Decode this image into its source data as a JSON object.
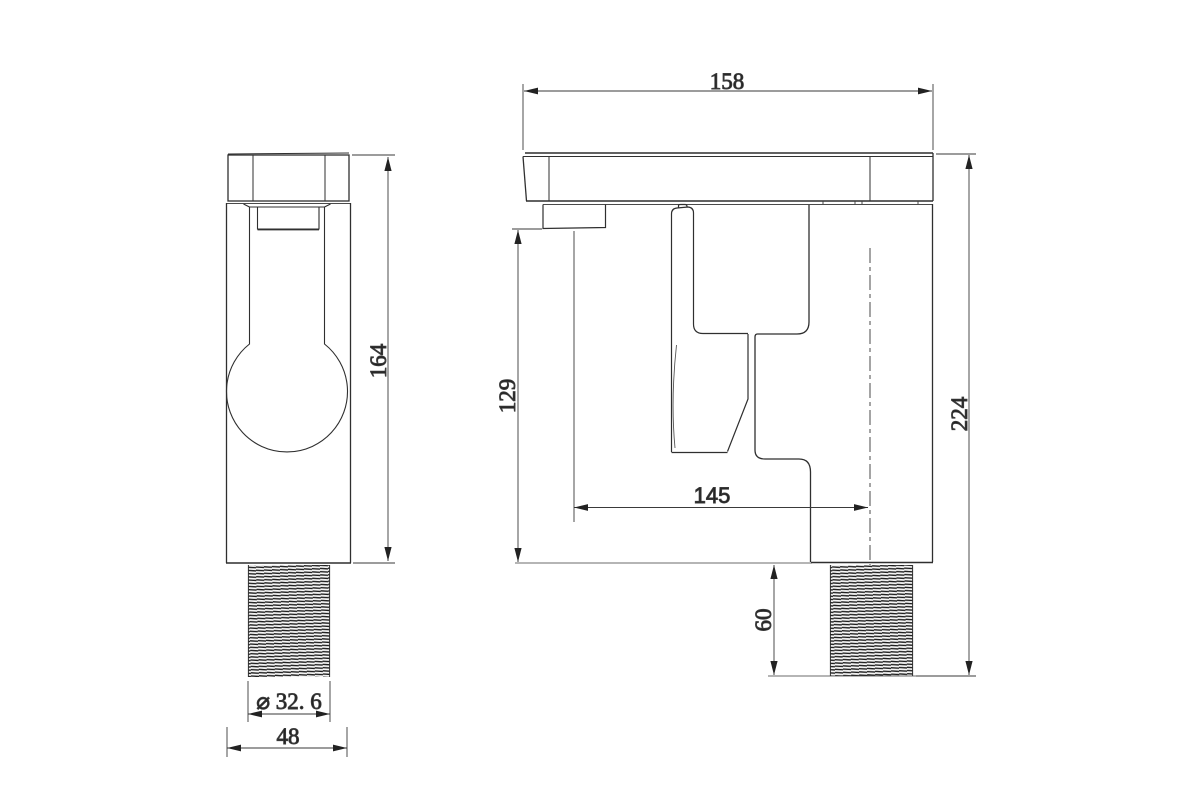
{
  "page": {
    "background": "#ffffff"
  },
  "drawing": {
    "type": "technical-dimension-drawing",
    "subject": "single-handle basin faucet, front and side orthographic views",
    "colors": {
      "outline": "#2f2f2f",
      "thin_line": "#4a4a4a",
      "dimension": "#3a3a3a",
      "thread_fill": "#1c1c1c"
    },
    "views": {
      "front": "front view",
      "side": "side view"
    },
    "labels": {
      "spout_length": "158",
      "overall_height": "224",
      "front_height": "164",
      "outlet_height": "129",
      "spout_reach": "145",
      "thread_length": "60",
      "thread_diameter": "⌀ 32. 6",
      "body_width": "48"
    }
  }
}
